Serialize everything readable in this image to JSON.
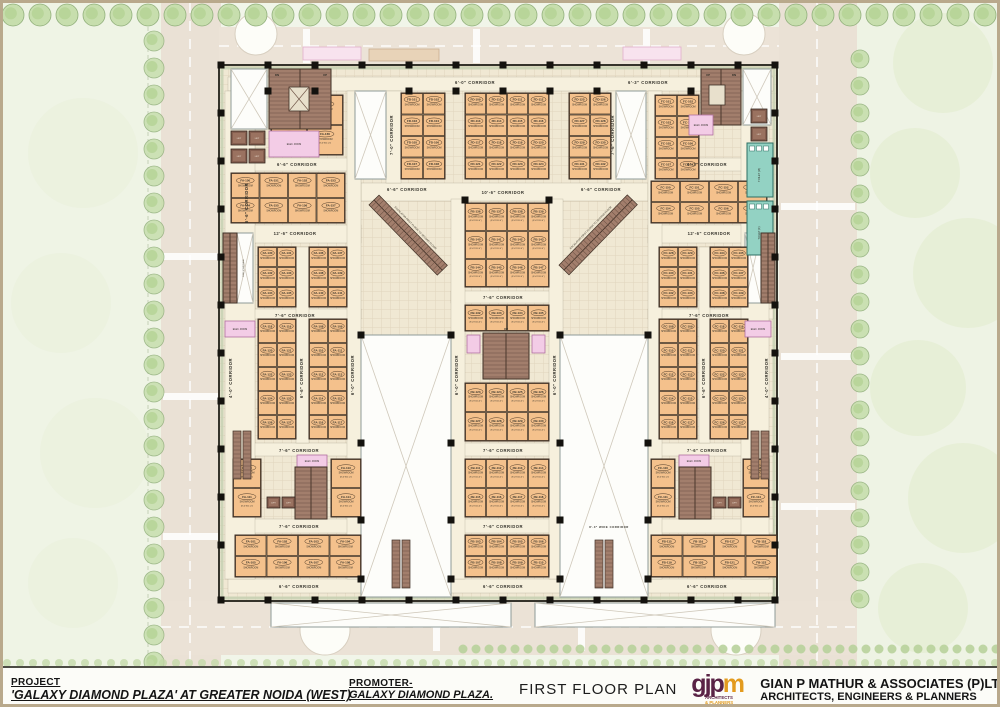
{
  "footer": {
    "project_label": "PROJECT",
    "project_name": "'GALAXY DIAMOND PLAZA' AT GREATER NOIDA (WEST)",
    "promoter_label": "PROMOTER-",
    "promoter_name": "GALAXY DIAMOND PLAZA.",
    "drawing_title": "FIRST FLOOR PLAN",
    "firm_logo_part1": "gjp",
    "firm_logo_part2": "m",
    "firm_logo_caption_1": "ARCHITECTS",
    "firm_logo_caption_2": "& PLANNERS",
    "firm_name": "GIAN P MATHUR & ASSOCIATES (P)LTD",
    "firm_subtitle": "ARCHITECTS, ENGINEERS & PLANNERS"
  },
  "colors": {
    "floor": "#f0e8d3",
    "corridor": "#f6f0dd",
    "shop": "#f4c18c",
    "shop_line": "#4d3a28",
    "stair": "#a27e6c",
    "stair_line": "#6b5042",
    "lift": "#855e4f",
    "toilet": "#93d2c3",
    "pink": "#f3cce6",
    "void": "#fdfdfa",
    "wall": "#35332b",
    "column": "#14120e",
    "road": "#eae1d5",
    "tree": "#c7dead",
    "tree_line": "#92b07c",
    "label": "#33312a"
  },
  "plan": {
    "unit": {
      "room": "SHOWROOM",
      "dims": "(8'-0\"X11'-0\")"
    },
    "escalator_label": "ESCALATOR FIRST FLOOR TO SECOND FLOOR",
    "fire_stair_label": "FIRE STAIRCASE",
    "lift_label": "LIFT",
    "elec_label": "ELEC. ROOM",
    "up_label": "UP",
    "dn_label": "DN",
    "toilets": [
      {
        "label": "TOILET (M)"
      },
      {
        "label": "TOILET (F)"
      }
    ],
    "corridor_labels": [
      {
        "text": "6'-0\" CORRIDOR",
        "x": 472,
        "y": 81
      },
      {
        "text": "6'-3\" CORRIDOR",
        "x": 645,
        "y": 81
      },
      {
        "text": "6'-6\" CORRIDOR",
        "x": 294,
        "y": 163
      },
      {
        "text": "6'-3\" CORRIDOR",
        "x": 704,
        "y": 163
      },
      {
        "text": "6'-6\" CORRIDOR",
        "x": 404,
        "y": 188
      },
      {
        "text": "10'-6\" CORRIDOR",
        "x": 500,
        "y": 191
      },
      {
        "text": "6'-6\" CORRIDOR",
        "x": 598,
        "y": 188
      },
      {
        "text": "12'-6\" CORRIDOR",
        "x": 292,
        "y": 232
      },
      {
        "text": "12'-6\" CORRIDOR",
        "x": 706,
        "y": 232
      },
      {
        "text": "7'-6\" CORRIDOR",
        "x": 500,
        "y": 296
      },
      {
        "text": "7'-6\" CORRIDOR",
        "x": 292,
        "y": 314
      },
      {
        "text": "7'-6\" CORRIDOR",
        "x": 706,
        "y": 314
      },
      {
        "text": "7'-6\" CORRIDOR",
        "x": 296,
        "y": 449
      },
      {
        "text": "7'-6\" CORRIDOR",
        "x": 500,
        "y": 449
      },
      {
        "text": "7'-6\" CORRIDOR",
        "x": 704,
        "y": 449
      },
      {
        "text": "7'-6\" CORRIDOR",
        "x": 296,
        "y": 525
      },
      {
        "text": "7'-6\" CORRIDOR",
        "x": 500,
        "y": 525
      },
      {
        "text": "8'-0\" WIDE CORRIDOR",
        "x": 606,
        "y": 525,
        "size": 2.8
      },
      {
        "text": "6'-6\" CORRIDOR",
        "x": 296,
        "y": 585
      },
      {
        "text": "6'-6\" CORRIDOR",
        "x": 500,
        "y": 585
      },
      {
        "text": "6'-6\" CORRIDOR",
        "x": 704,
        "y": 585
      },
      {
        "text": "6'-6\" CORRIDOR",
        "x": 245,
        "y": 200,
        "rot": -90
      },
      {
        "text": "4'-0\" CORRIDOR",
        "x": 229,
        "y": 375,
        "rot": -90
      },
      {
        "text": "6'-6\" CORRIDOR",
        "x": 300,
        "y": 375,
        "rot": -90
      },
      {
        "text": "6'-0\" CORRIDOR",
        "x": 351,
        "y": 372,
        "rot": -90
      },
      {
        "text": "7'-0\" CORRIDOR",
        "x": 390,
        "y": 132,
        "rot": -90
      },
      {
        "text": "7'-6\" CORRIDOR",
        "x": 611,
        "y": 132,
        "rot": -90
      },
      {
        "text": "6'-0\" CORRIDOR",
        "x": 455,
        "y": 372,
        "rot": -90
      },
      {
        "text": "6'-0\" CORRIDOR",
        "x": 553,
        "y": 372,
        "rot": -90
      },
      {
        "text": "6'-6\" CORRIDOR",
        "x": 702,
        "y": 375,
        "rot": -90
      },
      {
        "text": "4'-0\" CORRIDOR",
        "x": 765,
        "y": 375,
        "rot": -90
      }
    ],
    "shop_blocks": [
      {
        "x": 268,
        "y": 92,
        "w": 72,
        "h": 60,
        "cols": 2,
        "rows": 2,
        "prefix": "FA",
        "start": 163
      },
      {
        "x": 228,
        "y": 170,
        "w": 114,
        "h": 50,
        "cols": 4,
        "rows": 2,
        "prefix": "FA",
        "start": 150
      },
      {
        "x": 398,
        "y": 90,
        "w": 44,
        "h": 86,
        "cols": 2,
        "rows": 4,
        "prefix": "FD",
        "start": 101
      },
      {
        "x": 462,
        "y": 90,
        "w": 84,
        "h": 86,
        "cols": 4,
        "rows": 4,
        "prefix": "FD",
        "start": 109
      },
      {
        "x": 566,
        "y": 90,
        "w": 42,
        "h": 86,
        "cols": 2,
        "rows": 4,
        "prefix": "FD",
        "start": 125
      },
      {
        "x": 652,
        "y": 92,
        "w": 44,
        "h": 84,
        "cols": 2,
        "rows": 4,
        "prefix": "FC",
        "start": 101
      },
      {
        "x": 652,
        "y": 130,
        "w": 0,
        "h": 0,
        "cols": 0,
        "rows": 0,
        "prefix": "FC",
        "start": 163
      },
      {
        "x": 648,
        "y": 178,
        "w": 116,
        "h": 42,
        "cols": 4,
        "rows": 2,
        "prefix": "FC",
        "start": 150
      },
      {
        "x": 255,
        "y": 244,
        "w": 38,
        "h": 60,
        "cols": 2,
        "rows": 3,
        "prefix": "FA",
        "start": 130
      },
      {
        "x": 306,
        "y": 244,
        "w": 38,
        "h": 60,
        "cols": 2,
        "rows": 3,
        "prefix": "FA",
        "start": 136
      },
      {
        "x": 255,
        "y": 316,
        "w": 38,
        "h": 120,
        "cols": 2,
        "rows": 5,
        "prefix": "FA",
        "start": 118
      },
      {
        "x": 306,
        "y": 316,
        "w": 38,
        "h": 120,
        "cols": 2,
        "rows": 5,
        "prefix": "FA",
        "start": 108
      },
      {
        "x": 656,
        "y": 244,
        "w": 38,
        "h": 60,
        "cols": 2,
        "rows": 3,
        "prefix": "FC",
        "start": 128
      },
      {
        "x": 707,
        "y": 244,
        "w": 38,
        "h": 60,
        "cols": 2,
        "rows": 3,
        "prefix": "FC",
        "start": 134
      },
      {
        "x": 656,
        "y": 316,
        "w": 38,
        "h": 120,
        "cols": 2,
        "rows": 5,
        "prefix": "FC",
        "start": 108
      },
      {
        "x": 707,
        "y": 316,
        "w": 38,
        "h": 120,
        "cols": 2,
        "rows": 5,
        "prefix": "FC",
        "start": 118
      },
      {
        "x": 462,
        "y": 200,
        "w": 84,
        "h": 84,
        "cols": 4,
        "rows": 3,
        "prefix": "FB",
        "start": 136
      },
      {
        "x": 462,
        "y": 302,
        "w": 84,
        "h": 26,
        "cols": 4,
        "rows": 1,
        "prefix": "FB",
        "start": 132
      },
      {
        "x": 462,
        "y": 380,
        "w": 84,
        "h": 58,
        "cols": 4,
        "rows": 2,
        "prefix": "FB",
        "start": 123
      },
      {
        "x": 462,
        "y": 456,
        "w": 84,
        "h": 58,
        "cols": 4,
        "rows": 2,
        "prefix": "FB",
        "start": 111
      },
      {
        "x": 462,
        "y": 532,
        "w": 84,
        "h": 42,
        "cols": 4,
        "rows": 2,
        "prefix": "FB",
        "start": 103
      },
      {
        "x": 232,
        "y": 532,
        "w": 126,
        "h": 42,
        "cols": 4,
        "rows": 2,
        "prefix": "FA",
        "start": 101
      },
      {
        "x": 648,
        "y": 532,
        "w": 126,
        "h": 42,
        "cols": 4,
        "rows": 2,
        "prefix": "FB",
        "start": 115
      },
      {
        "x": 230,
        "y": 456,
        "w": 28,
        "h": 58,
        "cols": 1,
        "rows": 2,
        "prefix": "FA",
        "start": 110
      },
      {
        "x": 328,
        "y": 456,
        "w": 30,
        "h": 58,
        "cols": 1,
        "rows": 2,
        "prefix": "FA",
        "start": 113
      },
      {
        "x": 648,
        "y": 456,
        "w": 24,
        "h": 58,
        "cols": 1,
        "rows": 2,
        "prefix": "FC",
        "start": 110
      },
      {
        "x": 740,
        "y": 456,
        "w": 26,
        "h": 58,
        "cols": 1,
        "rows": 2,
        "prefix": "FC",
        "start": 113
      }
    ]
  }
}
